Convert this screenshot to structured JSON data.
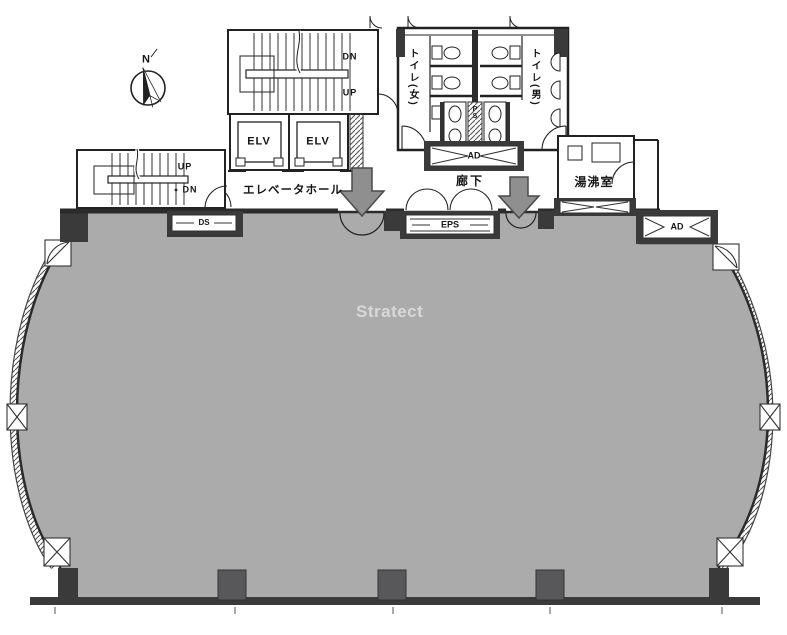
{
  "plan": {
    "watermark": "Stratect",
    "compass_n": "N",
    "labels": {
      "elevator_hall": "エレベータホール",
      "corridor": "廊下",
      "kitchenette": "湯沸室",
      "toilet_women": "トイレ(女)",
      "toilet_men": "トイレ(男)",
      "elevator_1": "ELV",
      "elevator_2": "ELV",
      "stairs_top_dn": "DN",
      "stairs_top_up": "UP",
      "stairs_left_up": "UP",
      "stairs_left_dn": "DN",
      "shaft_ps": "PS",
      "duct_ad_toilet": "AD",
      "duct_ad_right": "AD",
      "duct_eps": "EPS",
      "duct_ds_left": "DS"
    },
    "colors": {
      "floor": "#ABABAB",
      "wall": "#2B2B2B",
      "column": "#58585A",
      "entrance_arrow": "#8F8F8F",
      "watermark_text": "#D8D8D8"
    }
  }
}
